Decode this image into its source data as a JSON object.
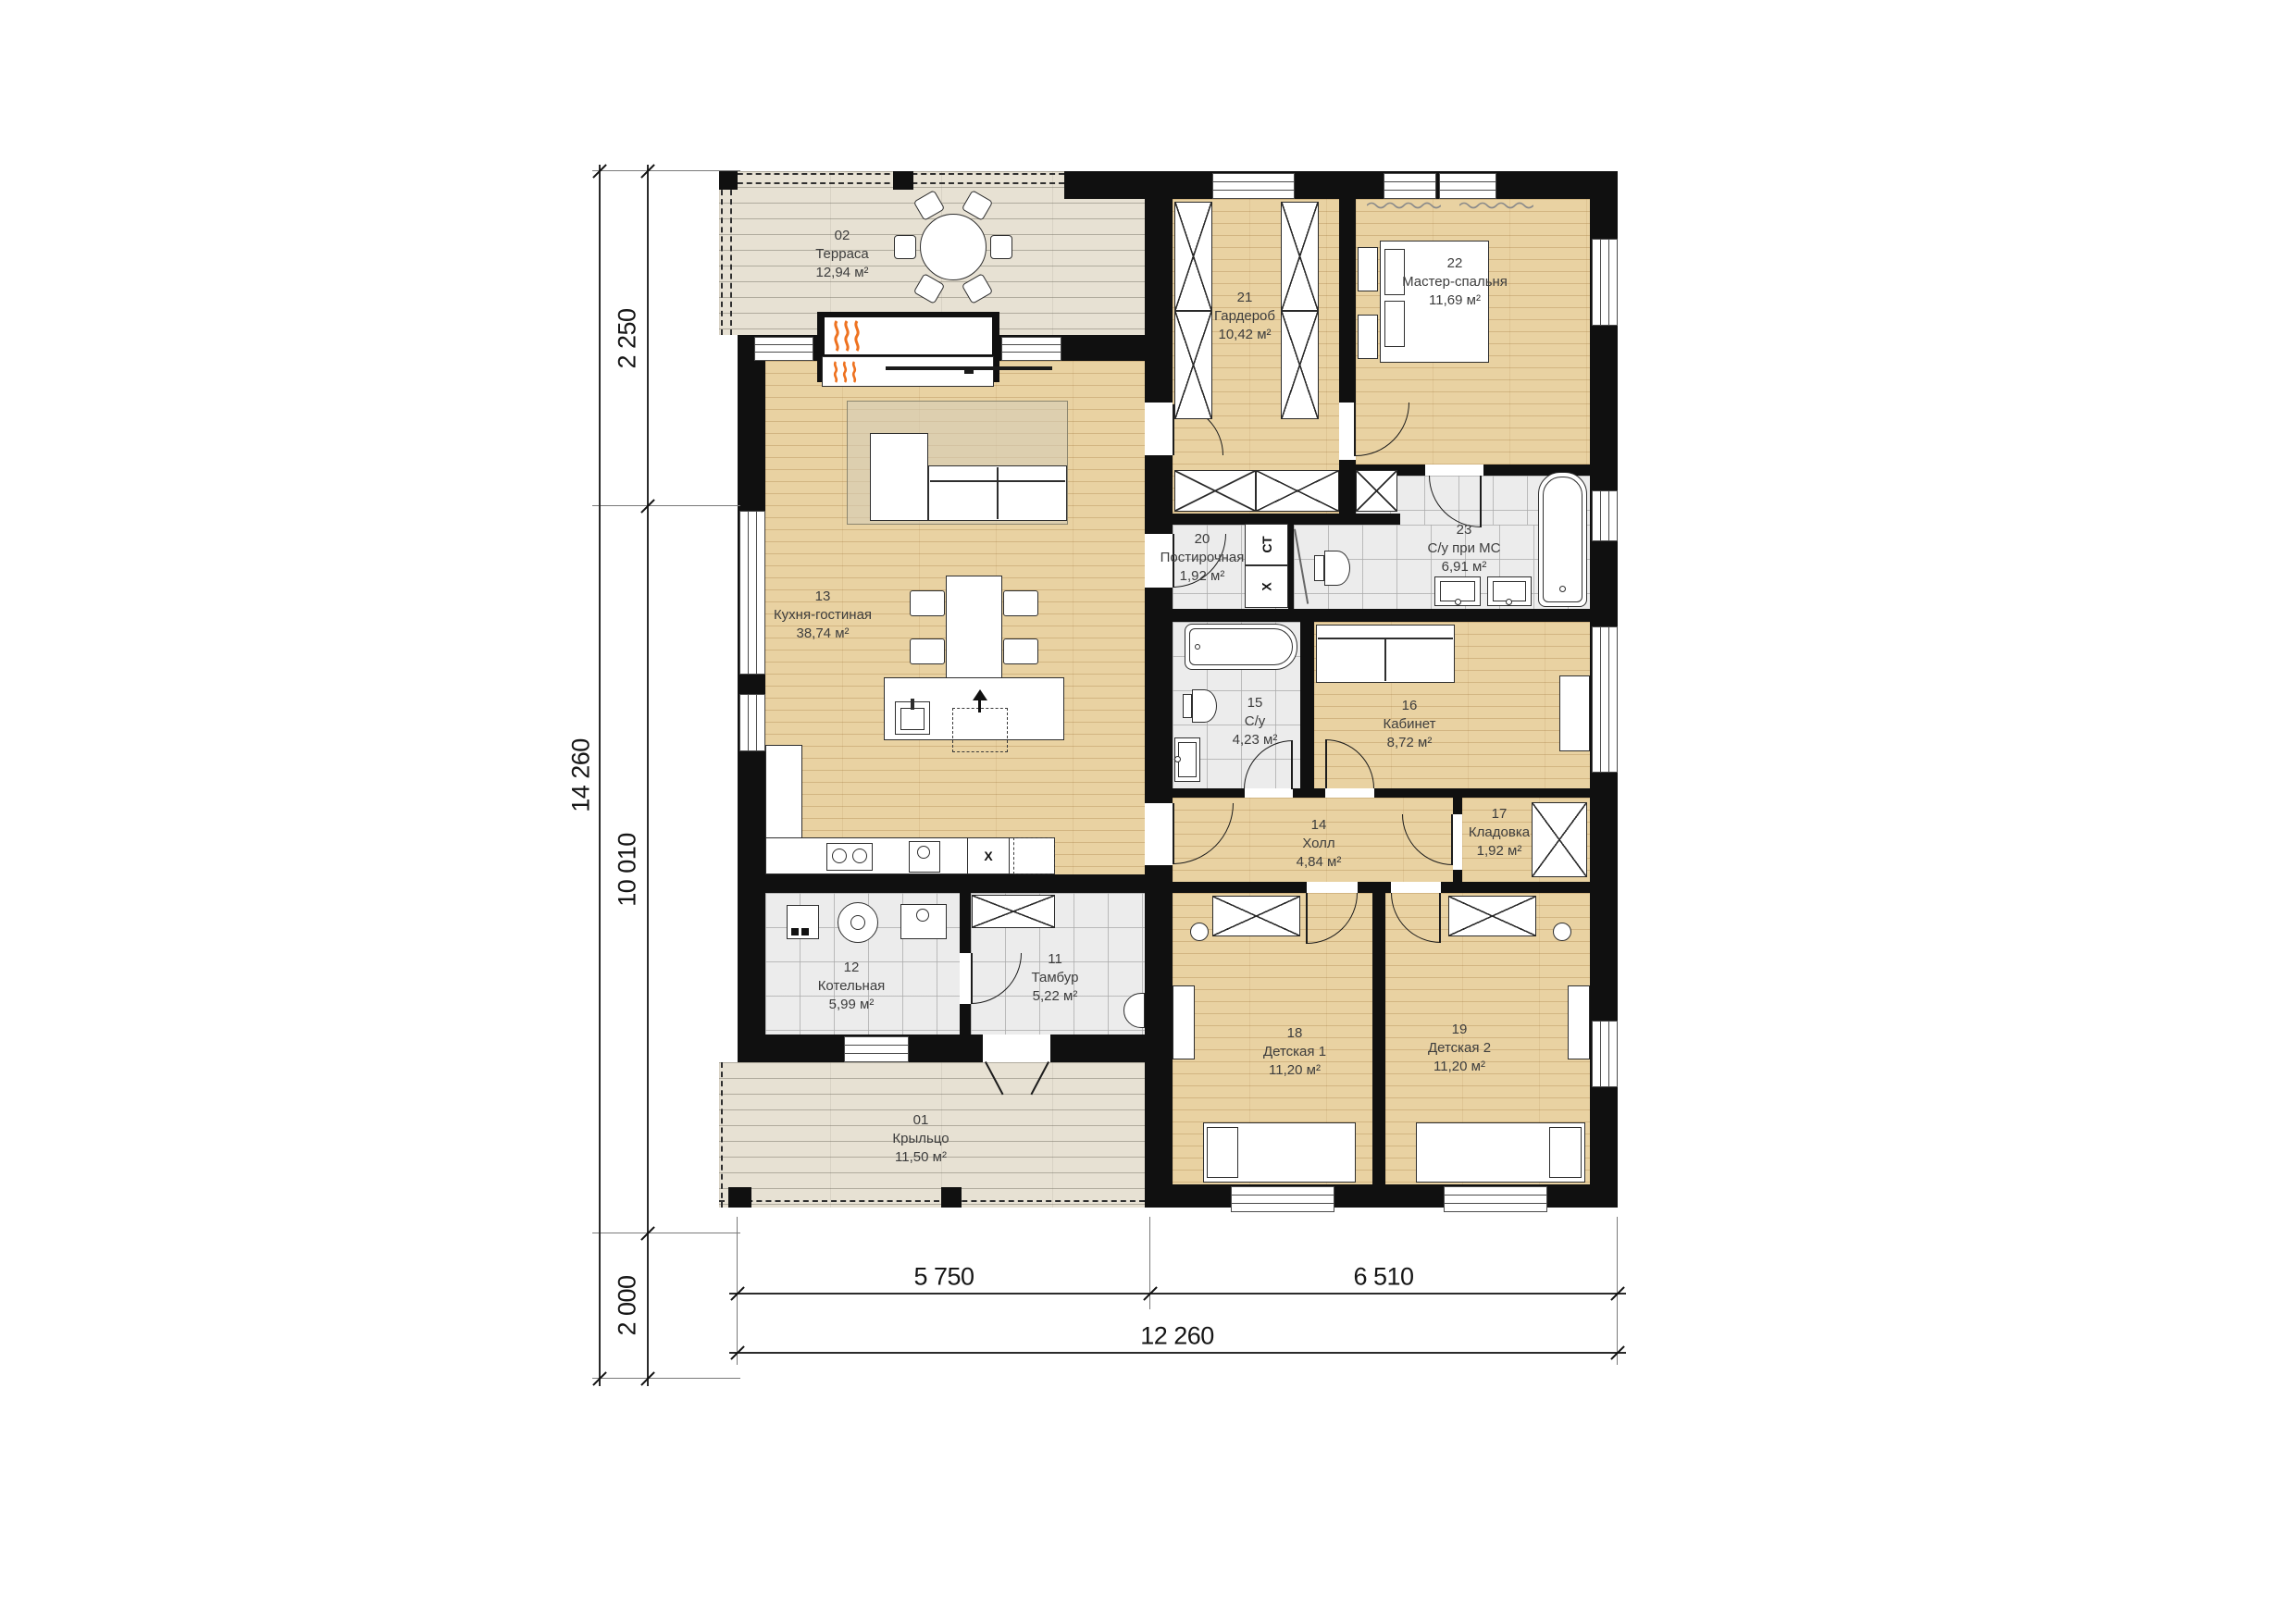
{
  "plan_title": "",
  "rooms": [
    {
      "num": "01",
      "name": "Крыльцо",
      "area": "11,50 м²"
    },
    {
      "num": "02",
      "name": "Терраса",
      "area": "12,94 м²"
    },
    {
      "num": "11",
      "name": "Тамбур",
      "area": "5,22 м²"
    },
    {
      "num": "12",
      "name": "Котельная",
      "area": "5,99 м²"
    },
    {
      "num": "13",
      "name": "Кухня-гостиная",
      "area": "38,74 м²"
    },
    {
      "num": "14",
      "name": "Холл",
      "area": "4,84 м²"
    },
    {
      "num": "15",
      "name": "С/у",
      "area": "4,23 м²"
    },
    {
      "num": "16",
      "name": "Кабинет",
      "area": "8,72 м²"
    },
    {
      "num": "17",
      "name": "Кладовка",
      "area": "1,92 м²"
    },
    {
      "num": "18",
      "name": "Детская 1",
      "area": "11,20 м²"
    },
    {
      "num": "19",
      "name": "Детская 2",
      "area": "11,20 м²"
    },
    {
      "num": "20",
      "name": "Постирочная",
      "area": "1,92 м²"
    },
    {
      "num": "21",
      "name": "Гардероб",
      "area": "10,42 м²"
    },
    {
      "num": "22",
      "name": "Мастер-спальня",
      "area": "11,69 м²"
    },
    {
      "num": "23",
      "name": "С/у при МС",
      "area": "6,91 м²"
    }
  ],
  "dimensions": {
    "left_total": "14 260",
    "left_top": "2 250",
    "left_mid": "10 010",
    "left_bottom": "2 000",
    "bottom_left": "5 750",
    "bottom_right": "6 510",
    "bottom_total": "12 260"
  },
  "appliances": {
    "washer_label": "СТ",
    "dryer_label": "X",
    "fridge_label": "X"
  },
  "palette": {
    "wall": "#101010",
    "wood_floor": "#e9d2a2",
    "deck_floor": "#e7e1d3",
    "tile_floor": "#ececec",
    "flame_accent": "#ee7220",
    "label_text": "#3d3d3d"
  }
}
